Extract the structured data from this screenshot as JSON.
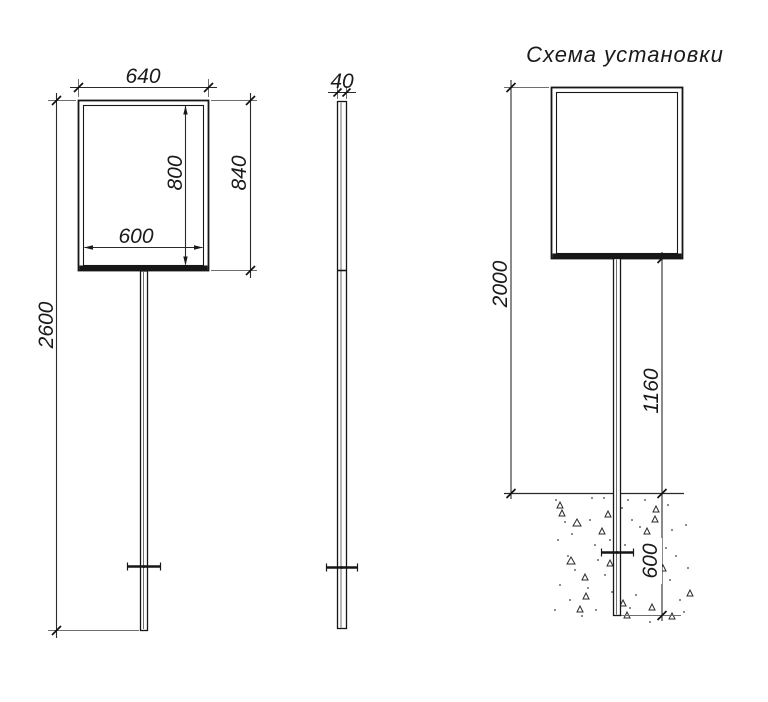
{
  "drawing": {
    "front_view": {
      "dim_width_outer": "640",
      "dim_height_outer": "840",
      "dim_width_inner": "600",
      "dim_height_inner": "800",
      "dim_total_height": "2600"
    },
    "side_view": {
      "dim_thickness": "40"
    },
    "installation_view": {
      "title": "Схема установки",
      "dim_above_ground": "2000",
      "dim_post_above_ground": "1160",
      "dim_embedment_depth": "600"
    },
    "colors": {
      "line": "#161616",
      "dim_line": "#2a2a2a",
      "ext_line": "#6e6e6e",
      "background": "#ffffff"
    }
  }
}
